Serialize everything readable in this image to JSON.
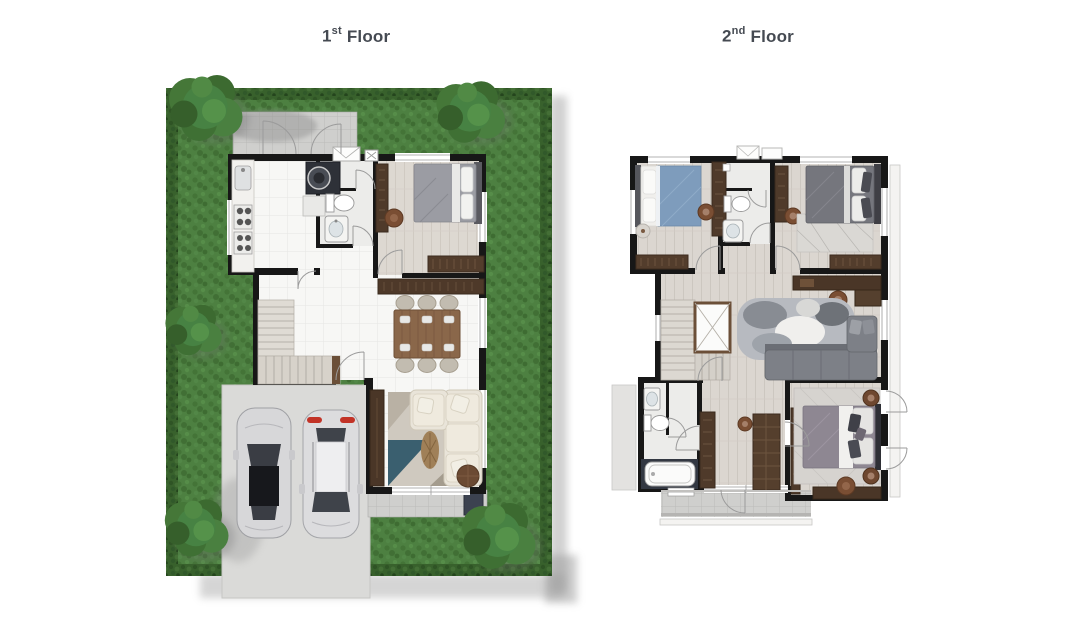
{
  "titles": {
    "floor1": {
      "number": "1",
      "ordinal": "st",
      "word": "Floor"
    },
    "floor2": {
      "number": "2",
      "ordinal": "nd",
      "word": "Floor"
    }
  },
  "palette": {
    "title_text": "#454a52",
    "lawn_green": "#4d8041",
    "hedge_green": "#38612c",
    "tree_green": "#3f7034",
    "shadow_gray": "#a3a3a3",
    "wall_black": "#171717",
    "wood_dark": "#4f3a2a",
    "wood_mid": "#7a4e33",
    "tile_white": "#f7f7f5",
    "wood_floor": "#ddd8d1",
    "terrace_tile": "#cfcfcd",
    "concrete": "#dadad8",
    "car_silver": "#d7d7d9",
    "sofa_cream": "#e9e4d9",
    "sofa_gray": "#7d8087",
    "bed_blue": "#7e9cbc",
    "bed_gray": "#75767d",
    "bed_purple_gray": "#8e8792",
    "rug_teal": "#2e5668"
  },
  "floor1": {
    "rooms": [
      "garden",
      "entrance-terrace",
      "kitchen",
      "laundry-bathroom",
      "bedroom",
      "dining-area",
      "stairs",
      "living-area",
      "rear-terrace",
      "carport",
      "driveway"
    ],
    "furniture": [
      "kitchen-counter",
      "sink",
      "stove",
      "washing-machine",
      "toilet",
      "wash-basin",
      "double-bed",
      "wardrobe",
      "dresser",
      "sideboard",
      "dining-table",
      "dining-chairs",
      "tv-cabinet",
      "corner-sofa",
      "rug",
      "dried-plant",
      "pouf",
      "sedan-car",
      "suv-car",
      "garden-trees"
    ]
  },
  "floor2": {
    "rooms": [
      "bedroom-2",
      "shared-bathroom",
      "bedroom-3",
      "family-hall",
      "stairwell",
      "master-bathroom",
      "walk-in-closet",
      "master-bedroom",
      "balcony"
    ],
    "furniture": [
      "single-bed",
      "wardrobes",
      "dressers",
      "nightstands",
      "toilet",
      "wash-basin",
      "double-bed",
      "area-rugs",
      "desk",
      "desk-chair",
      "corner-sofa",
      "bathtub",
      "shower",
      "king-bed",
      "bench",
      "pouf"
    ]
  }
}
